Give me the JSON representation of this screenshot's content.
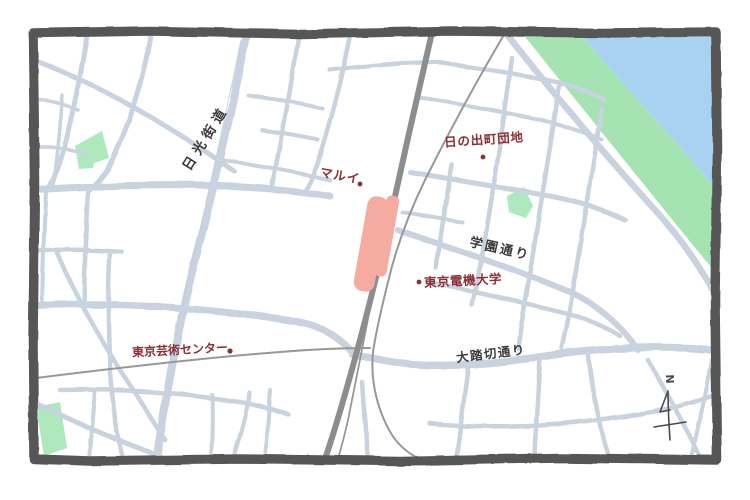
{
  "map": {
    "colors": {
      "road": "#c9d2df",
      "railway": "#8d8d8d",
      "rail_thin": "#989898",
      "river": "#a8d2f0",
      "riverbank": "#a6e3b2",
      "park": "#aee9bd",
      "station": "#f5ab9f",
      "poi_label": "#8b3034",
      "road_label": "#3b3b3b",
      "frame": "#575757"
    },
    "road_labels": [
      {
        "id": "nikko-kaido",
        "text": "日光街道"
      },
      {
        "id": "gakuen-dori",
        "text": "学園通り"
      },
      {
        "id": "ofumikiri-dori",
        "text": "大踏切通り"
      }
    ],
    "poi_labels": [
      {
        "id": "marui",
        "text": "マルイ"
      },
      {
        "id": "hinodecho-danchi",
        "text": "日の出町団地"
      },
      {
        "id": "tokyo-denki-university",
        "text": "東京電機大学"
      },
      {
        "id": "tokyo-geijutsu-center",
        "text": "東京芸術センター"
      }
    ],
    "compass": {
      "north_label": "N"
    }
  }
}
